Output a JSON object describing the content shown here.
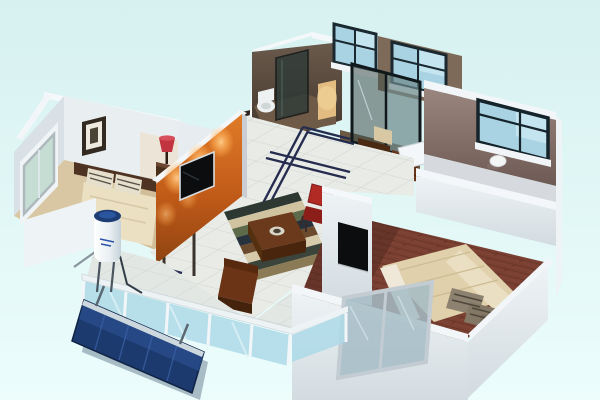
{
  "scene": {
    "description": "3D isometric cutaway floor-plan render of a furnished apartment floating on a pale cyan background",
    "background": {
      "top": "#d6f1f0",
      "bottom": "#ecfdfc"
    },
    "palette": {
      "wall_bright": "#f5f8fa",
      "wall_light": "#e9eef1",
      "wall_mid": "#d9e1e6",
      "wall_shadow": "#c4ccd2",
      "orange_base": "#c05a18",
      "orange_dark": "#8f4412",
      "spot_glow": "#ffb057",
      "tv_black": "#0c0d0f",
      "tv_frame": "#d8dcde",
      "carpet": "#d8c7a2",
      "blanket_master": "#ece0c2",
      "pillow_base": "#e6dfcc",
      "pillow_stripe": "#57514a",
      "headboard": "#4e3322",
      "nightstand": "#4a2e1c",
      "lamp_red": "#c23540",
      "picture_frame": "#332b22",
      "picture_mat": "#efeadf",
      "picture_art": "#4a4436",
      "bath_wall": "#54463c",
      "bath_floor": "#6e5a46",
      "niche_lit": "#e2bc80",
      "toilet_white": "#eef1f1",
      "partition_glass": "#2c3a38",
      "kitchen_floor": "#6b5842",
      "table_brown": "#4a2a12",
      "chair_beige": "#d8c9a4",
      "cabinet_brown": "#66351a",
      "door_white": "#f4f7f9",
      "taupe_wall": "#8d7a73",
      "window_frame_navy": "#1a2830",
      "window_glass": "#a9d2e2",
      "window_glass_light": "#c4e4f0",
      "window_sill": "#f2f5f7",
      "ceiling_lamp": "#f4f6f6",
      "tile": "#e9ebe7",
      "tile_line": "#c9cfc9",
      "inlay_navy": "#252c4e",
      "wood_floor": "#7a4032",
      "plank_dark": "#5e2d22",
      "blanket_bedroom3": "#e0d0ac",
      "pillow3_base": "#8d8170",
      "pillow3_stripe": "#4e463a",
      "red_chair": "#b22a24",
      "red_chair_dark": "#8c1e19",
      "ottoman_top": "#6b3a1c",
      "ottoman_front": "#4a250e",
      "armchair_brown": "#6b3417",
      "rail_glass": "#add9e8",
      "rail_frame": "#edf2f4",
      "solar_panel": "#1c3a6e",
      "solar_panel_light": "#2c5192",
      "solar_panel_edge": "#cdd8de",
      "heater_cap": "#1d3c74",
      "heater_logo": "#2a52a8",
      "metal_gray": "#4a5560"
    },
    "rug": {
      "stripes": [
        "#2e3833",
        "#cfc3a0",
        "#5d6b4a",
        "#27323c",
        "#6b4a2e",
        "#d6cbaa",
        "#3a443a",
        "#8a7a55"
      ]
    },
    "rooms": {
      "master_bedroom": {
        "floor": "beige carpet",
        "objects": [
          "double bed",
          "striped pillows",
          "dark headboard",
          "nightstand",
          "red table lamp",
          "framed wall picture",
          "corner window"
        ]
      },
      "living_room": {
        "floor": "white tile",
        "objects": [
          "orange accent TV wall",
          "flat screen TV",
          "three wall spotlights",
          "striped area rug",
          "brown ottoman coffee table with dish",
          "red chair",
          "brown armchair"
        ]
      },
      "hallway": {
        "floor": "white tile with navy inlay border",
        "objects": [
          "dark door frame"
        ]
      },
      "bathroom": {
        "floor": "dark brown",
        "objects": [
          "toilet",
          "dark glass shower partition",
          "lit niche",
          "back window"
        ]
      },
      "kitchen": {
        "floor": "dark brown",
        "objects": [
          "glass sliding door",
          "back window",
          "small dining table",
          "two beige chairs",
          "brown cabinet",
          "open white door"
        ]
      },
      "bedroom_two": {
        "wall": "taupe with sliding window",
        "objects": [
          "ceiling lamp disc"
        ]
      },
      "bedroom_three": {
        "floor": "red-brown wood planks",
        "objects": [
          "double bed",
          "stacked striped pillows",
          "wall mounted TV",
          "front aluminium window"
        ]
      },
      "balcony": {
        "floor": "white tile",
        "objects": [
          "glass railing",
          "solar water heater tank",
          "tilted blue solar collector panel",
          "pipes"
        ]
      }
    }
  }
}
